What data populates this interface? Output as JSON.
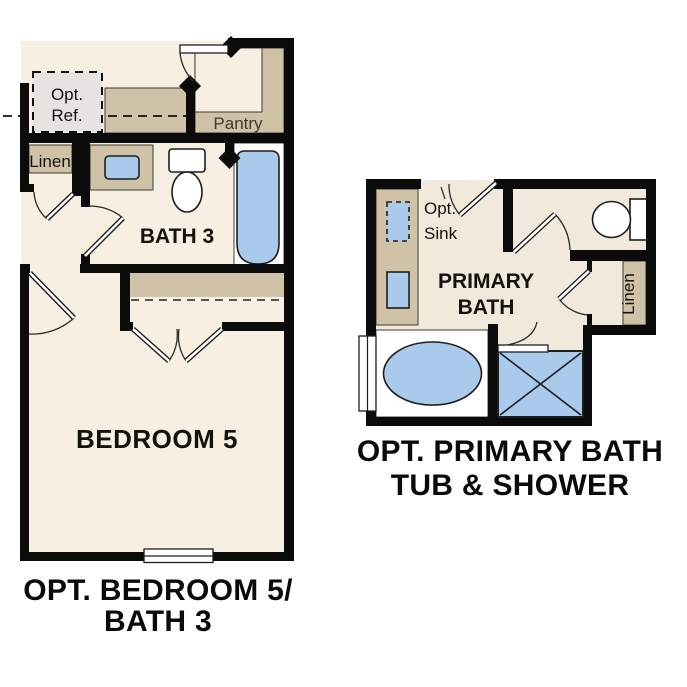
{
  "title": "Floor plan options",
  "colors": {
    "floor": "#f7efe1",
    "floor2": "#f1e9db",
    "counter": "#cfc2a6",
    "fixture": "#a9caeb",
    "wall": "#0b0b0b",
    "optional": "#e5e4e2",
    "labelmuted": "#3f3b31"
  },
  "left_plan": {
    "name": "Optional Bedroom 5 / Bath 3 plan",
    "labels": {
      "opt_ref_line1": "Opt.",
      "opt_ref_line2": "Ref.",
      "pantry": "Pantry",
      "linen": "Linen",
      "bath": "BATH 3",
      "bedroom": "BEDROOM 5"
    },
    "caption_line1": "OPT. BEDROOM 5/",
    "caption_line2": "BATH 3"
  },
  "right_plan": {
    "name": "Optional Primary Bath plan",
    "labels": {
      "opt_sink_line1": "Opt.",
      "opt_sink_line2": "Sink",
      "room_line1": "PRIMARY",
      "room_line2": "BATH",
      "linen": "Linen"
    },
    "caption_line1": "OPT. PRIMARY BATH",
    "caption_line2": "TUB & SHOWER"
  }
}
